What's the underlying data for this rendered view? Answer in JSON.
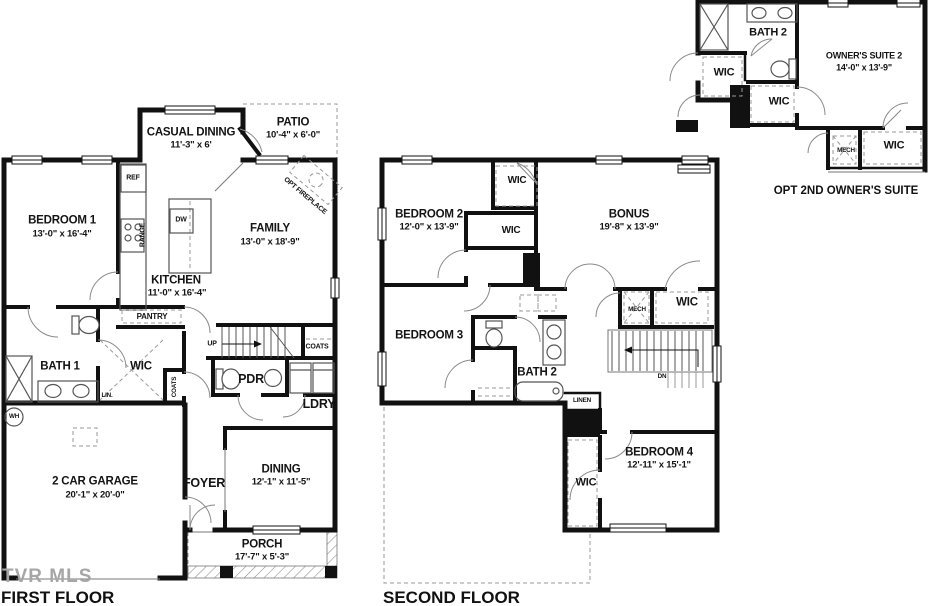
{
  "first_floor": {
    "title": "FIRST FLOOR",
    "watermark": "TVR MLS",
    "labels": {
      "casual_dining": {
        "name": "CASUAL DINING",
        "dims": "11'-3\" x 6'"
      },
      "patio": {
        "name": "PATIO",
        "dims": "10'-4\" x 6'-0\""
      },
      "bedroom1": {
        "name": "BEDROOM 1",
        "dims": "13'-0\" x 16'-4\""
      },
      "family": {
        "name": "FAMILY",
        "dims": "13'-0\" x 18'-9\""
      },
      "kitchen": {
        "name": "KITCHEN",
        "dims": "11'-0\" x 16'-4\""
      },
      "garage": {
        "name": "2 CAR GARAGE",
        "dims": "20'-1\" x 20'-0\""
      },
      "dining": {
        "name": "DINING",
        "dims": "12'-1\" x 11'-5\""
      },
      "porch": {
        "name": "PORCH",
        "dims": "17'-7\" x 5'-3\""
      },
      "foyer": "FOYER",
      "bath1": "BATH 1",
      "wic": "WIC",
      "pdr": "PDR",
      "ldry": "LDRY",
      "pantry": "PANTRY",
      "ref": "REF",
      "range": "RANGE",
      "dw": "DW",
      "lin": "LIN.",
      "wh": "WH",
      "coats_hall": "COATS",
      "coats_stairs": "COATS",
      "up": "UP",
      "opt_fireplace": "OPT FIREPLACE"
    }
  },
  "second_floor": {
    "title": "SECOND FLOOR",
    "labels": {
      "bedroom2": {
        "name": "BEDROOM 2",
        "dims": "12'-0\" x 13'-9\""
      },
      "bonus": {
        "name": "BONUS",
        "dims": "19'-8\" x 13'-9\""
      },
      "bedroom3": "BEDROOM 3",
      "bedroom4": {
        "name": "BEDROOM 4",
        "dims": "12'-11\" x 15'-1\""
      },
      "bath2": "BATH 2",
      "wic_top": "WIC",
      "wic_mid": "WIC",
      "wic_right": "WIC",
      "wic_bedroom4": "WIC",
      "mech": "MECH",
      "linen": "LINEN",
      "dn": "DN"
    }
  },
  "owners_suite": {
    "title": "OPT 2ND OWNER'S SUITE",
    "labels": {
      "suite": {
        "name": "OWNER'S SUITE 2",
        "dims": "14'-0\" x 13'-9\""
      },
      "bath2": "BATH 2",
      "wic_left": "WIC",
      "wic_mid": "WIC",
      "wic_bottom": "WIC",
      "mech": "MECH"
    }
  }
}
